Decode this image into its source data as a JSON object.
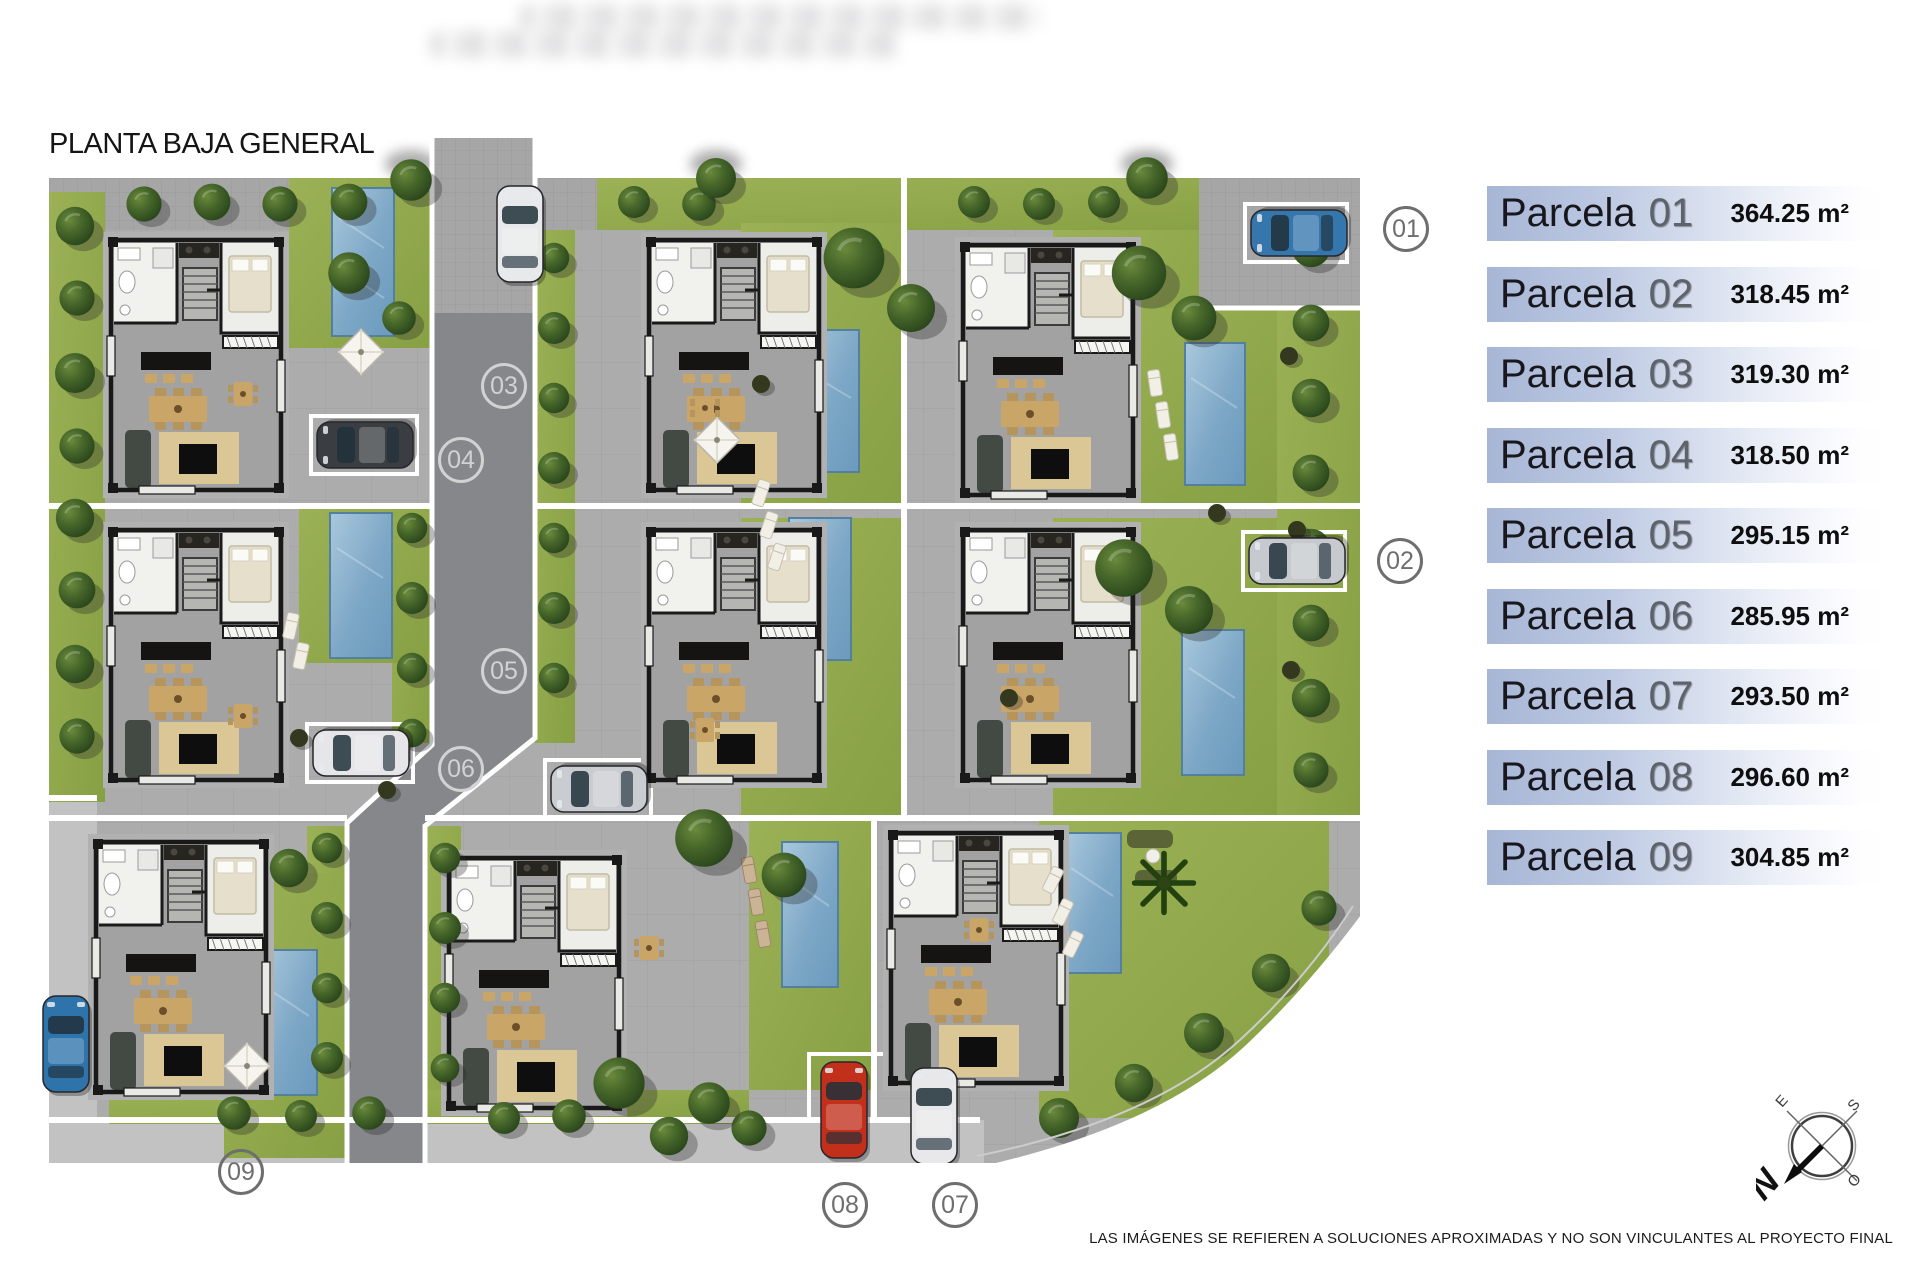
{
  "title": "PLANTA BAJA GENERAL",
  "disclaimer": "LAS IMÁGENES SE REFIEREN A SOLUCIONES APROXIMADAS Y NO SON VINCULANTES AL PROYECTO FINAL",
  "legend": {
    "items": [
      {
        "prefix": "Parcela",
        "num": "01",
        "area": "364.25 m²"
      },
      {
        "prefix": "Parcela",
        "num": "02",
        "area": "318.45 m²"
      },
      {
        "prefix": "Parcela",
        "num": "03",
        "area": "319.30 m²"
      },
      {
        "prefix": "Parcela",
        "num": "04",
        "area": "318.50 m²"
      },
      {
        "prefix": "Parcela",
        "num": "05",
        "area": "295.15 m²"
      },
      {
        "prefix": "Parcela",
        "num": "06",
        "area": "285.95 m²"
      },
      {
        "prefix": "Parcela",
        "num": "07",
        "area": "293.50 m²"
      },
      {
        "prefix": "Parcela",
        "num": "08",
        "area": "296.60 m²"
      },
      {
        "prefix": "Parcela",
        "num": "09",
        "area": "304.85 m²"
      }
    ],
    "colors": {
      "bar_from": "#a7b6d6",
      "bar_to": "#ffffff",
      "name": "#17171d",
      "number": "#5d636b",
      "area": "#0e0e0e"
    }
  },
  "plan_markers": [
    {
      "label": "01"
    },
    {
      "label": "02"
    },
    {
      "label": "03"
    },
    {
      "label": "04"
    },
    {
      "label": "05"
    },
    {
      "label": "06"
    },
    {
      "label": "07"
    },
    {
      "label": "08"
    },
    {
      "label": "09"
    }
  ],
  "compass": {
    "n": "N",
    "e": "E",
    "s": "S",
    "o": "O"
  }
}
